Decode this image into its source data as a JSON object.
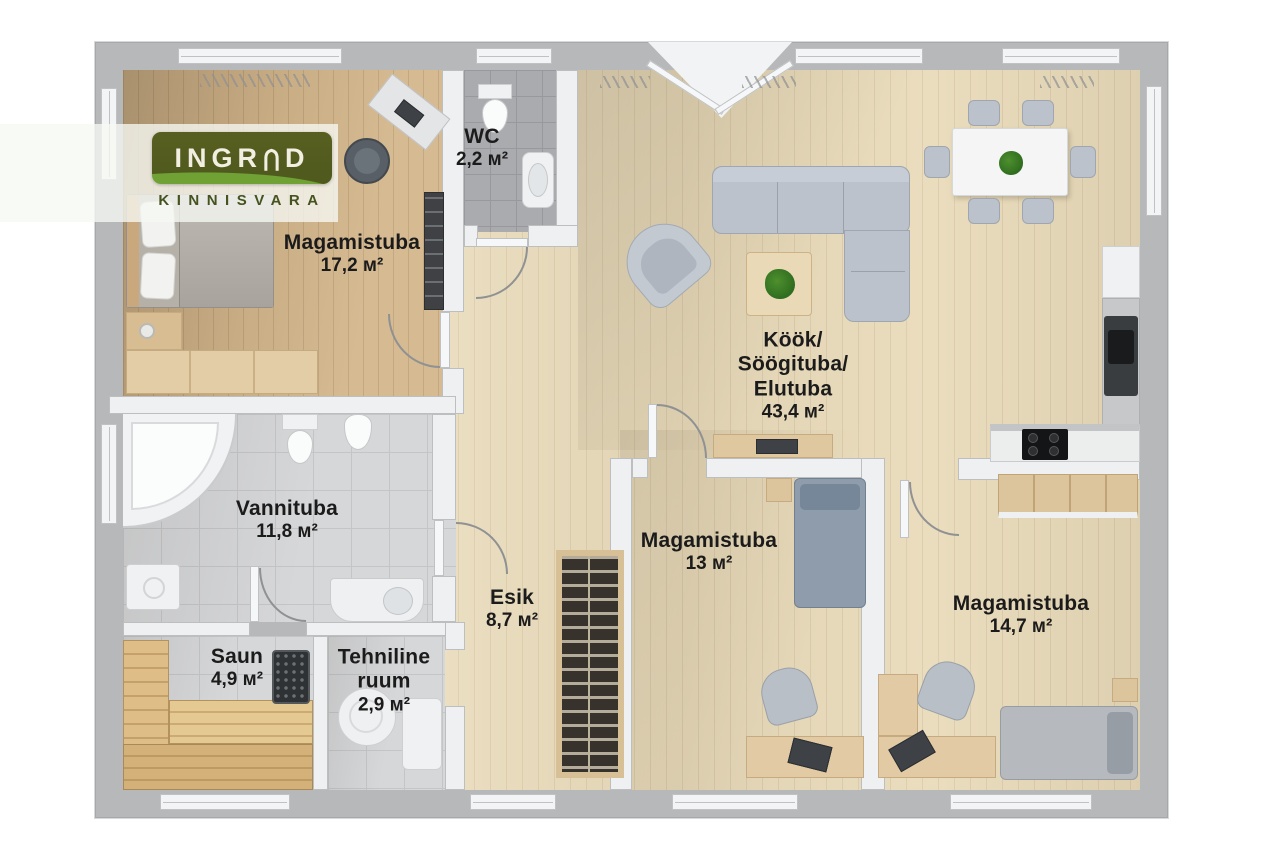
{
  "brand": {
    "logo_text": "INGRAD",
    "logo_part1": "INGR",
    "logo_part2": "D",
    "logo_subtext": "KINNISVARA"
  },
  "rooms": {
    "bedroom1": {
      "name": "Magamistuba",
      "area": "17,2 м²"
    },
    "wc": {
      "name": "WC",
      "area": "2,2 м²"
    },
    "living": {
      "name_line1": "Köök/",
      "name_line2": "Söögituba/",
      "name_line3": "Elutuba",
      "area": "43,4 м²"
    },
    "bathroom": {
      "name": "Vannituba",
      "area": "11,8 м²"
    },
    "sauna": {
      "name": "Saun",
      "area": "4,9 м²"
    },
    "tech": {
      "name_line1": "Tehniline",
      "name_line2": "ruum",
      "area": "2,9 м²"
    },
    "hall": {
      "name": "Esik",
      "area": "8,7 м²"
    },
    "bedroom2": {
      "name": "Magamistuba",
      "area": "13 м²"
    },
    "bedroom3": {
      "name": "Magamistuba",
      "area": "14,7 м²"
    }
  },
  "colors": {
    "logo_green_dark": "#515c1e",
    "logo_green_light": "#6e9e33",
    "logo_text_color": "#f2efe2",
    "logo_sub_color": "#45531f",
    "label_text": "#1b1b1b",
    "wall_outer": "#b7b8ba",
    "wall_inner": "#eff0f1",
    "wood_light": "#e9dbba",
    "wood_medium": "#d3b68c",
    "tile_light": "#d6d7d9",
    "tile_dark": "#a9abaf",
    "sofa_gray": "#bcc2cb",
    "plant_green": "#3c7a24"
  }
}
